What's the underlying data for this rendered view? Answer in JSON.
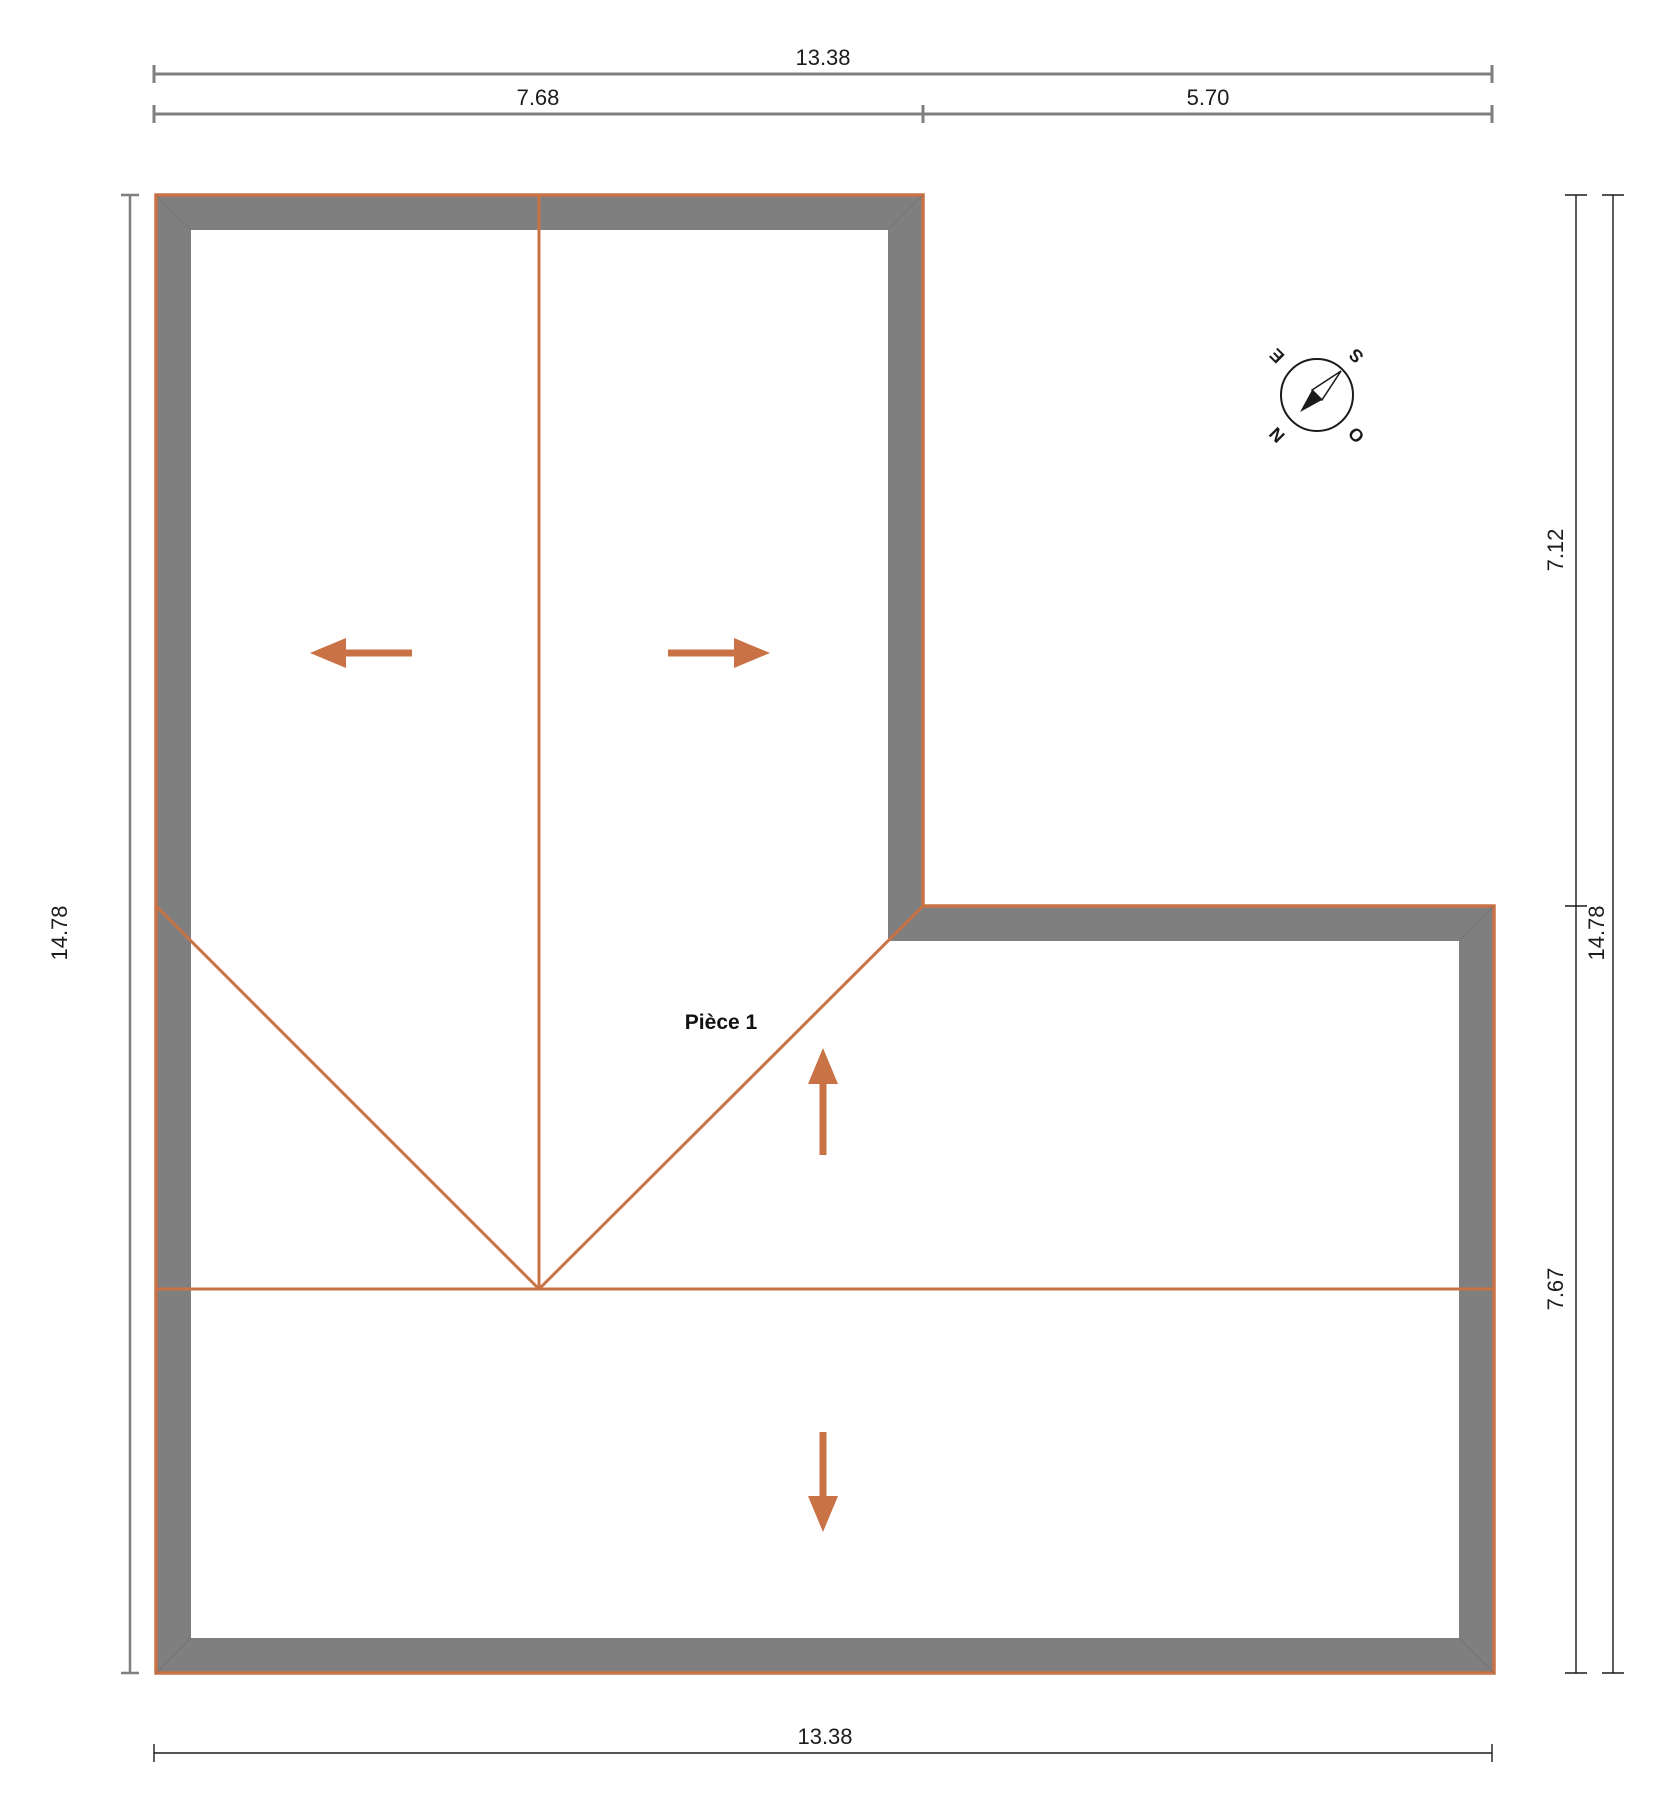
{
  "plan": {
    "room_label": "Pièce 1",
    "dims": {
      "top_total": "13.38",
      "top_left_segment": "7.68",
      "top_right_segment": "5.70",
      "left_height": "14.78",
      "right_upper": "7.12",
      "right_total": "14.78",
      "right_lower": "7.67",
      "bottom_total": "13.38"
    },
    "compass": {
      "n": "N",
      "e": "E",
      "s": "S",
      "o": "O"
    },
    "colors": {
      "wall_gray": "#7f7f7f",
      "roof_orange": "#c97245",
      "dim_gray": "#7f7f7f",
      "dim_dark": "#1a1a1a",
      "text": "#1c1c1c"
    }
  }
}
